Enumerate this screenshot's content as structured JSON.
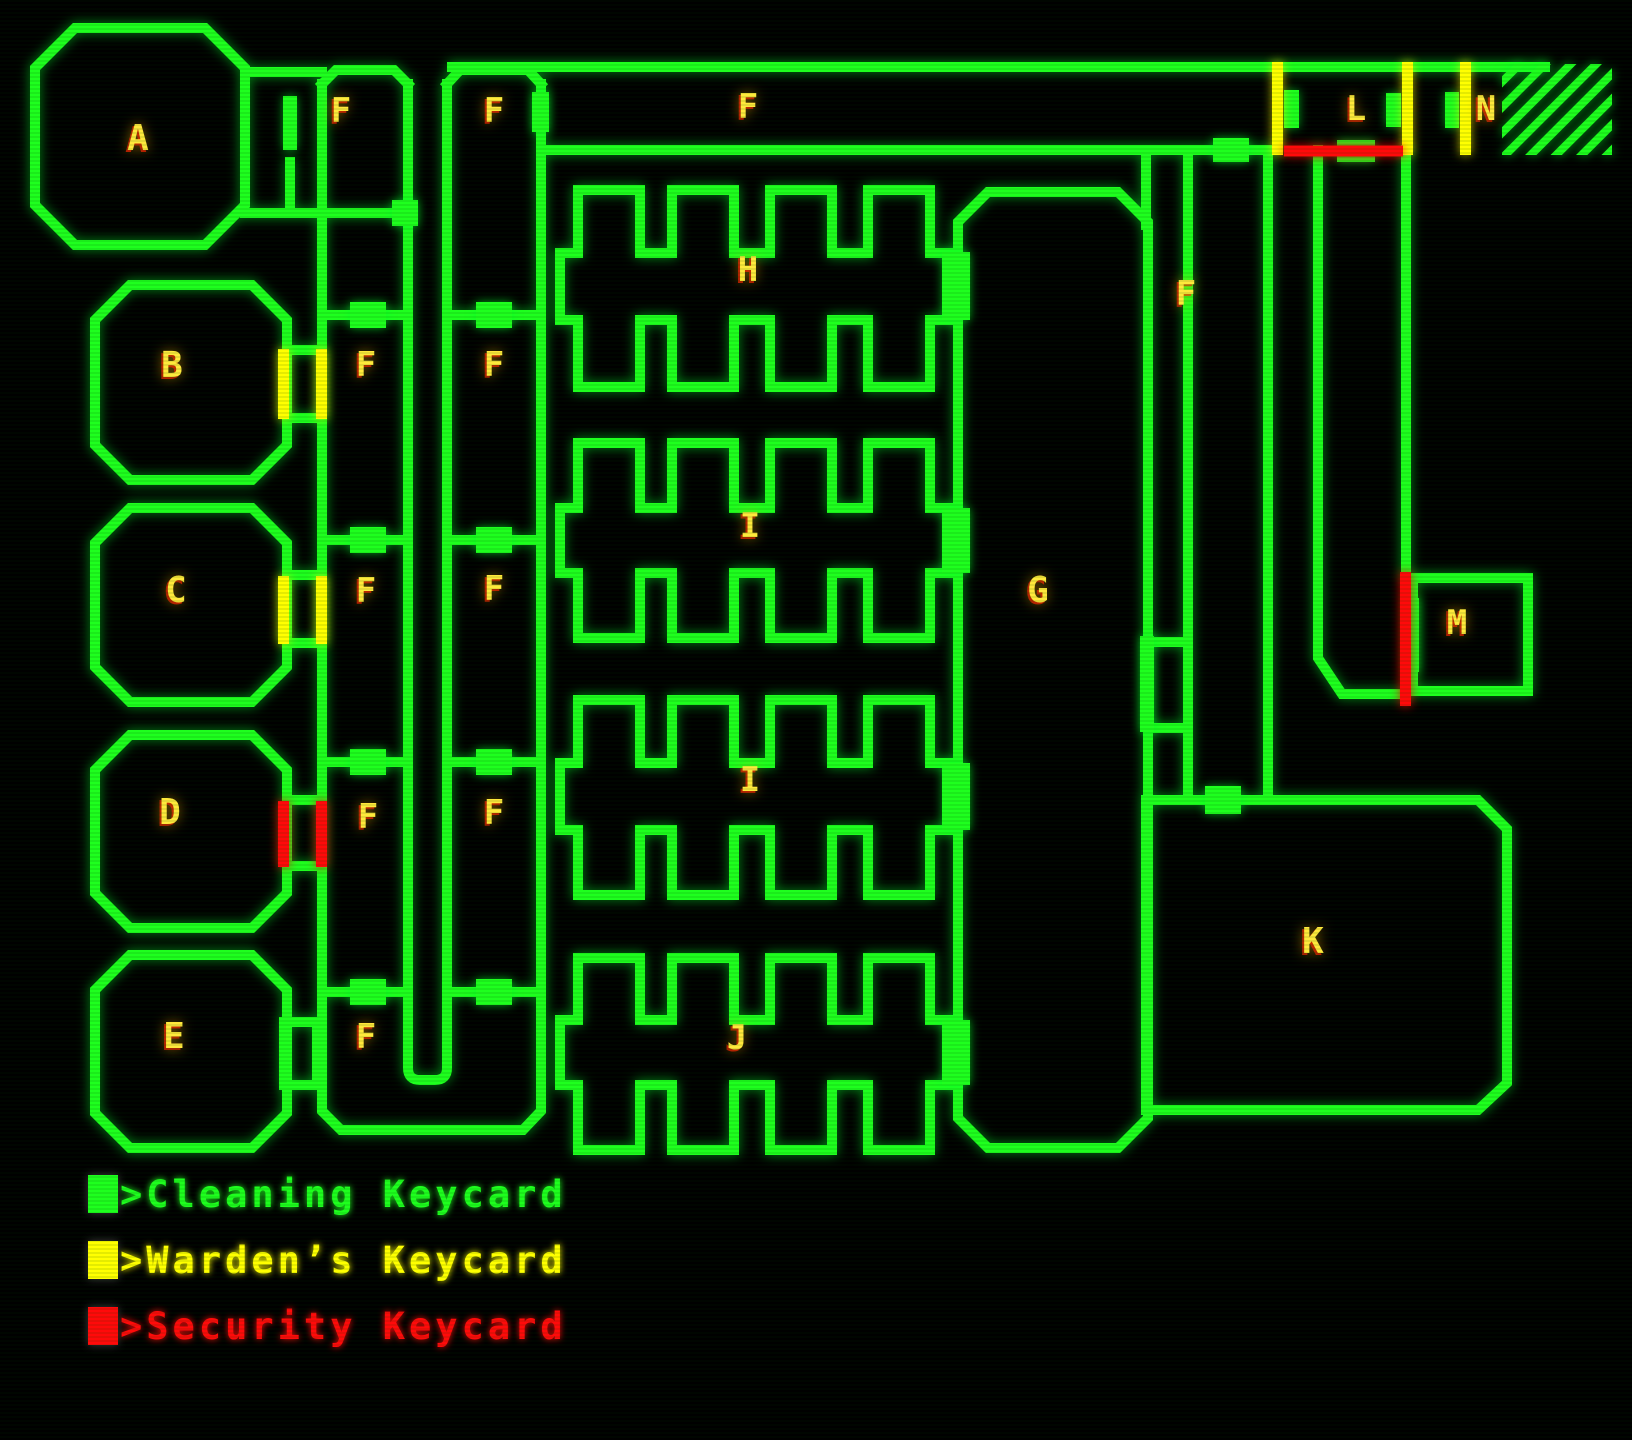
{
  "map": {
    "room_labels": {
      "a": "A",
      "b": "B",
      "c": "C",
      "d": "D",
      "e": "E",
      "f": "F",
      "g": "G",
      "h": "H",
      "i": "I",
      "j": "J",
      "k": "K",
      "l": "L",
      "m": "M",
      "n": "N"
    }
  },
  "legend": {
    "items": [
      {
        "label": ">Cleaning Keycard",
        "color": "#1eff1e"
      },
      {
        "label": ">Warden’s Keycard",
        "color": "#ffff00"
      },
      {
        "label": ">Security Keycard",
        "color": "#ff0a0a"
      }
    ]
  },
  "colors": {
    "wall": "#1eff1e",
    "label": "#ffe93c",
    "warden_door": "#ffff00",
    "security_door": "#ff0a0a",
    "background": "#000000"
  }
}
